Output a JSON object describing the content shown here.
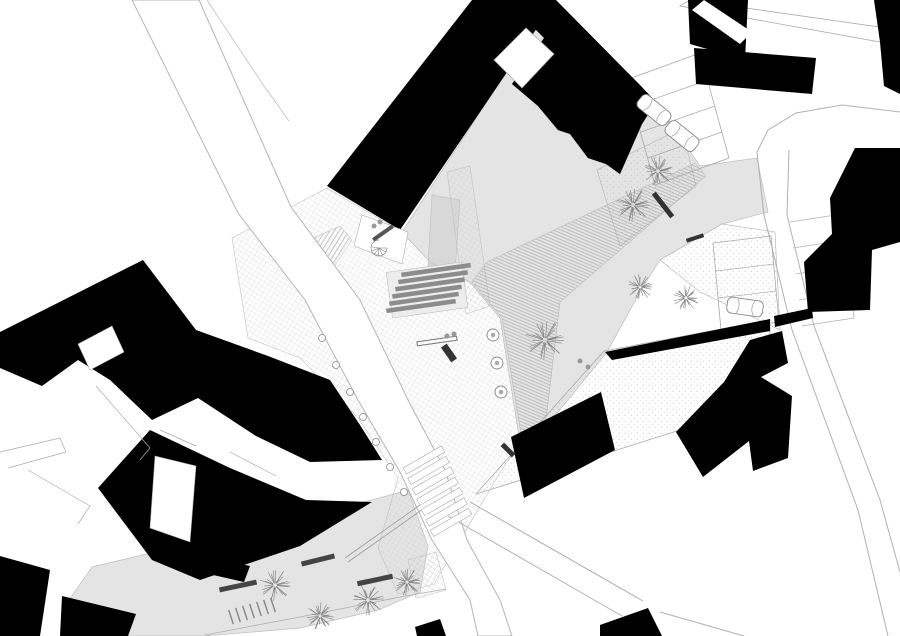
{
  "meta": {
    "type": "architectural-site-plan",
    "description": "black-and-white figure-ground site plan of a public plaza between buildings",
    "width": 900,
    "height": 636
  },
  "colors": {
    "building": "#000000",
    "plaza_gray": "#e4e4e4",
    "terrace_gray": "#d8d8d8",
    "road_line": "#b0b0b0",
    "outline": "#bdbdbd",
    "hatch_line": "#9c9c9c",
    "grid_line": "#c9c9c9",
    "stipple_dot": "#b8b8b8",
    "tree_line": "#808080",
    "bench_dark": "#333333",
    "background": "#ffffff"
  },
  "plan": {
    "layers": [
      {
        "name": "plaza-main-gray",
        "kind": "poly",
        "pts": "402,232 540,20 552,30 512,84 538,106 558,130 570,134 588,158 606,164 620,174 642,124 656,102 700,166 757,158 768,212 722,224 660,260 640,292 607,352 545,428 520,442 500,318 470,282 430,262",
        "fill": "#e4e4e4",
        "stroke": "#bdbdbd",
        "sw": 0.7
      },
      {
        "name": "courtyard-gray",
        "kind": "poly",
        "pts": "92,567 372,500 408,490 428,546 420,592 378,610 300,628 205,636 100,636 62,610",
        "fill": "#e4e4e4",
        "stroke": "#bdbdbd",
        "sw": 0.7
      },
      {
        "name": "terrace-strip-gray",
        "kind": "poly",
        "pts": "432,195 460,200 455,272 428,266",
        "fill": "#d8d8d8",
        "stroke": "#bdbdbd",
        "sw": 0.6
      },
      {
        "name": "planting-strip-upper",
        "kind": "poly",
        "pts": "597,170 682,128 696,186 620,246",
        "fill": "stip",
        "stroke": "#bbbbbb",
        "sw": 0.7
      },
      {
        "name": "planting-strip-lower",
        "kind": "poly",
        "pts": "722,224 775,232 780,330 700,292 660,260",
        "fill": "stip",
        "stroke": "#bbbbbb",
        "sw": 0.7
      },
      {
        "name": "stipple-wedge",
        "kind": "poly",
        "pts": "476,494 604,351 770,320 770,334 680,430 560,468",
        "fill": "stip",
        "stroke": "#aaaaaa",
        "sw": 0.8
      },
      {
        "name": "paving-grid-main",
        "kind": "poly",
        "pts": "232,238 327,188 402,232 430,262 470,282 500,318 520,442 498,476 434,584 398,594 378,548 398,478 358,418 300,358 248,338",
        "fill": "grid",
        "stroke": "#c2c2c2",
        "sw": 0.6
      },
      {
        "name": "paving-grid-walkway",
        "kind": "poly",
        "pts": "447,172 470,166 490,306 466,314",
        "fill": "grid",
        "stroke": "#c2c2c2",
        "sw": 0.6
      },
      {
        "name": "paving-grid-south",
        "kind": "poly",
        "pts": "408,560 436,552 446,590 416,598",
        "fill": "grid",
        "stroke": "#c2c2c2",
        "sw": 0.6
      },
      {
        "name": "stepped-ramp-hatch",
        "kind": "poly",
        "pts": "487,262 695,163 706,176 560,302 545,428 522,440 502,318 472,282",
        "fill": "diagA",
        "stroke": "#b0b0b0",
        "sw": 0.5
      },
      {
        "name": "ramp-hatch-west",
        "kind": "poly",
        "pts": "296,246 340,226 352,240 314,296 296,288",
        "fill": "diagB",
        "stroke": "#b0b0b0",
        "sw": 0.5
      },
      {
        "name": "street-west",
        "kind": "poly",
        "pts": "132,0 199,0 291,207 360,300 408,400 445,470 467,540 500,600 512,636 478,636 470,600 432,540 400,472 358,400 305,300 238,213",
        "fill": "#ffffff",
        "stroke": "#b5b5b5",
        "sw": 1
      },
      {
        "name": "street-west-inner-line",
        "kind": "pline",
        "pts": "207,0 262,83 289,121",
        "stroke": "#c0c0c0",
        "sw": 0.8
      },
      {
        "name": "street-east-edge-a",
        "kind": "pline",
        "pts": "757,152 764,215 792,330 858,510 888,636",
        "stroke": "#b0b0b0",
        "sw": 1
      },
      {
        "name": "street-east-edge-b",
        "kind": "pline",
        "pts": "789,150 787,215 814,326 880,500 900,572",
        "stroke": "#b0b0b0",
        "sw": 1
      },
      {
        "name": "street-corner-curve",
        "kind": "pline",
        "pts": "757,152 768,130 796,113 842,105 900,112",
        "stroke": "#b0b0b0",
        "sw": 1
      },
      {
        "name": "street-south-edge-a",
        "kind": "pline",
        "pts": "448,516 622,616",
        "stroke": "#b0b0b0",
        "sw": 1
      },
      {
        "name": "street-south-edge-b",
        "kind": "pline",
        "pts": "470,502 643,601",
        "stroke": "#b0b0b0",
        "sw": 1
      },
      {
        "name": "street-south-edge-c",
        "kind": "pline",
        "pts": "660,612 744,636",
        "stroke": "#b0b0b0",
        "sw": 1
      },
      {
        "name": "link-bridge-outline",
        "kind": "poly",
        "pts": "680,6 690,0 886,28 880,42",
        "fill": "#ffffff",
        "stroke": "#aaaaaa",
        "sw": 0.8
      },
      {
        "name": "parking-stalls-east",
        "kind": "seg",
        "segs": [
          [
            790,
            222,
            842,
            214
          ],
          [
            793,
            248,
            845,
            240
          ],
          [
            796,
            274,
            848,
            266
          ],
          [
            799,
            300,
            851,
            292
          ],
          [
            802,
            326,
            854,
            318
          ],
          [
            842,
            214,
            854,
            318
          ]
        ],
        "stroke": "#b0b0b0",
        "sw": 0.8
      },
      {
        "name": "parking-bay-mid",
        "kind": "poly",
        "pts": "713,243 771,236 779,322 721,330",
        "fill": "none",
        "stroke": "#a8a8a8",
        "sw": 0.8
      },
      {
        "name": "parking-bay-mid-dividers",
        "kind": "seg",
        "segs": [
          [
            716,
            271,
            774,
            264
          ],
          [
            718,
            298,
            776,
            291
          ]
        ],
        "stroke": "#a8a8a8",
        "sw": 0.7
      },
      {
        "name": "parking-bay-north",
        "kind": "poly",
        "pts": "626,80 700,53 729,158 655,185",
        "fill": "none",
        "stroke": "#a8a8a8",
        "sw": 0.8
      },
      {
        "name": "parking-bay-north-dividers",
        "kind": "seg",
        "segs": [
          [
            634,
            106,
            708,
            80
          ],
          [
            641,
            132,
            715,
            106
          ],
          [
            648,
            158,
            722,
            132
          ]
        ],
        "stroke": "#a8a8a8",
        "sw": 0.7
      },
      {
        "name": "building-band-nw",
        "kind": "poly",
        "pts": "327,186 472,0 556,0 400,230",
        "fill": "#000000"
      },
      {
        "name": "building-band-ne",
        "kind": "poly",
        "pts": "556,0 640,85 656,102 642,124 620,174 606,164 588,158 570,134 558,130 538,106 512,84 544,38 528,22 548,0",
        "fill": "#000000"
      },
      {
        "name": "building-courtyard-notch",
        "kind": "poly",
        "pts": "494,60 526,28 554,54 522,88",
        "fill": "#ffffff",
        "stroke": "#aaaaaa",
        "sw": 0.7
      },
      {
        "name": "building-tr-a",
        "kind": "poly",
        "pts": "688,0 748,0 745,60 690,44",
        "fill": "#000000"
      },
      {
        "name": "building-tr-a-slot",
        "kind": "poly",
        "pts": "692,10 704,0 752,32 740,44",
        "fill": "#ffffff"
      },
      {
        "name": "building-tr-b",
        "kind": "poly",
        "pts": "694,48 816,58 812,94 696,84",
        "fill": "#000000"
      },
      {
        "name": "building-edge-ne",
        "kind": "poly",
        "pts": "874,0 900,0 900,94 884,86 880,42",
        "fill": "#000000"
      },
      {
        "name": "building-east-stepped",
        "kind": "poly",
        "pts": "855,148 900,148 900,242 872,250 870,310 808,312 804,262 832,234 830,198",
        "fill": "#000000"
      },
      {
        "name": "building-wedge-sliver",
        "kind": "poly",
        "pts": "605,352 770,319 770,331 612,360",
        "fill": "#000000"
      },
      {
        "name": "building-wedge-sliver-b",
        "kind": "poly",
        "pts": "774,316 812,308 813,318 775,327",
        "fill": "#000000"
      },
      {
        "name": "building-z-block",
        "kind": "poly",
        "pts": "676,432 724,382 750,340 782,331 788,363 761,377 792,396 788,458 753,471 749,441 703,477",
        "fill": "#000000"
      },
      {
        "name": "building-parallelogram",
        "kind": "poly",
        "pts": "511,437 601,392 615,450 524,498",
        "fill": "#000000"
      },
      {
        "name": "building-corner-south",
        "kind": "poly",
        "pts": "600,625 648,608 662,636 600,636",
        "fill": "#000000"
      },
      {
        "name": "building-south-small",
        "kind": "poly",
        "pts": "415,627 440,619 446,636 417,636",
        "fill": "#000000"
      },
      {
        "name": "building-west-upper",
        "kind": "poly",
        "pts": "0,332 143,260 196,330 268,356 330,380 360,425 382,460 310,462 256,436 198,398 152,420 110,380 78,360 42,386 0,368",
        "fill": "#000000"
      },
      {
        "name": "building-west-upper-court",
        "kind": "poly",
        "pts": "78,344 112,326 124,352 90,370",
        "fill": "#ffffff",
        "stroke": "#aaaaaa",
        "sw": 0.6
      },
      {
        "name": "building-west-lower",
        "kind": "poly",
        "pts": "150,430 230,468 306,500 372,502 300,546 200,580 152,560 122,520 98,488",
        "fill": "#000000"
      },
      {
        "name": "building-west-lower-court",
        "kind": "poly",
        "pts": "155,456 196,466 190,542 150,528",
        "fill": "#ffffff",
        "stroke": "#aaaaaa",
        "sw": 0.6
      },
      {
        "name": "building-sw-corner-a",
        "kind": "poly",
        "pts": "0,556 50,570 40,636 0,636",
        "fill": "#000000"
      },
      {
        "name": "building-sw-corner-b",
        "kind": "poly",
        "pts": "62,596 136,614 128,636 60,636",
        "fill": "#000000"
      },
      {
        "name": "building-sw-small",
        "kind": "poly",
        "pts": "204,556 250,566 244,582 200,572",
        "fill": "#000000"
      },
      {
        "name": "terrace-pocket",
        "kind": "poly",
        "pts": "362,215 408,232 402,264 354,246",
        "fill": "#ffffff",
        "stroke": "#bbbbbb",
        "sw": 0.7
      },
      {
        "name": "structure-lines-west",
        "kind": "seg",
        "segs": [
          [
            0,
            452,
            60,
            438
          ],
          [
            60,
            438,
            66,
            452
          ],
          [
            66,
            452,
            8,
            468
          ],
          [
            28,
            470,
            90,
            506
          ],
          [
            90,
            506,
            78,
            524
          ],
          [
            96,
            386,
            150,
            448
          ],
          [
            150,
            448,
            140,
            460
          ],
          [
            160,
            430,
            196,
            446
          ],
          [
            230,
            452,
            276,
            476
          ]
        ],
        "stroke": "#aaaaaa",
        "sw": 0.7
      },
      {
        "name": "courtyard-ramp-wall",
        "kind": "seg",
        "segs": [
          [
            345,
            558,
            420,
            505
          ],
          [
            348,
            562,
            423,
            509
          ]
        ],
        "stroke": "#999999",
        "sw": 0.8
      },
      {
        "name": "courtyard-south-edge",
        "kind": "pline",
        "pts": "205,635 300,617 400,597 446,589",
        "stroke": "#b0b0b0",
        "sw": 0.8
      },
      {
        "name": "steps-base",
        "kind": "bar",
        "x": 427,
        "y": 290,
        "len": 76,
        "w": 46,
        "rot": -8,
        "fill": "#ededed",
        "stroke": "#bbbbbb",
        "sw": 0.6
      },
      {
        "name": "steps-treads",
        "kind": "bars",
        "len": 70,
        "w": 4.5,
        "rot": -8,
        "fill": "#8c8c8c",
        "items": [
          [
            436,
            270
          ],
          [
            433,
            277.2
          ],
          [
            430,
            284.4
          ],
          [
            427,
            291.6
          ],
          [
            424,
            298.8
          ],
          [
            421,
            306
          ]
        ]
      },
      {
        "name": "crosswalk-stripes",
        "kind": "bars",
        "len": 44,
        "w": 7,
        "rot": -30,
        "fill": "#ffffff",
        "stroke": "#aaaaaa",
        "sw": 0.6,
        "items": [
          [
            424,
            460
          ],
          [
            428.5,
            470.4
          ],
          [
            433,
            480.8
          ],
          [
            437.5,
            491.2
          ],
          [
            442,
            501.6
          ],
          [
            446.5,
            512
          ],
          [
            451,
            522.4
          ]
        ]
      },
      {
        "name": "bike-racks",
        "kind": "bars",
        "len": 15,
        "w": 1.4,
        "rot": 72,
        "fill": "#888888",
        "items": [
          [
            231,
            617
          ],
          [
            238,
            615
          ],
          [
            245,
            613
          ],
          [
            252,
            611
          ],
          [
            259,
            609
          ],
          [
            266,
            607
          ],
          [
            273,
            605
          ]
        ]
      },
      {
        "name": "bench-terrace",
        "kind": "bar",
        "x": 383,
        "y": 233,
        "len": 24,
        "w": 4,
        "rot": -35,
        "fill": "#555555"
      },
      {
        "name": "bench-plaza-long",
        "kind": "bar",
        "x": 437,
        "y": 341,
        "len": 40,
        "w": 4,
        "rot": -8,
        "fill": "none",
        "stroke": "#777777",
        "sw": 1
      },
      {
        "name": "bench-plaza-dark",
        "kind": "bar",
        "x": 449,
        "y": 353,
        "len": 18,
        "w": 7,
        "rot": 55,
        "fill": "#333333"
      },
      {
        "name": "bench-upper-east",
        "kind": "bar",
        "x": 663,
        "y": 205,
        "len": 30,
        "w": 5,
        "rot": 52,
        "fill": "#333333"
      },
      {
        "name": "bench-strip-east",
        "kind": "bar",
        "x": 695,
        "y": 238,
        "len": 18,
        "w": 4,
        "rot": -18,
        "fill": "#333333"
      },
      {
        "name": "bench-courtyard-a",
        "kind": "bar",
        "x": 238,
        "y": 586,
        "len": 38,
        "w": 5,
        "rot": -12,
        "fill": "#444444"
      },
      {
        "name": "bench-courtyard-b",
        "kind": "bar",
        "x": 375,
        "y": 580,
        "len": 36,
        "w": 5,
        "rot": -12,
        "fill": "#444444"
      },
      {
        "name": "bench-courtyard-c",
        "kind": "bar",
        "x": 318,
        "y": 560,
        "len": 34,
        "w": 5,
        "rot": -14,
        "fill": "#444444"
      },
      {
        "name": "bench-wedge",
        "kind": "bar",
        "x": 508,
        "y": 450,
        "len": 16,
        "w": 5,
        "rot": 45,
        "fill": "#333333"
      },
      {
        "name": "bollard-row",
        "kind": "dot",
        "r": 3.5,
        "fill": "#ffffff",
        "stroke": "#888888",
        "sw": 0.8,
        "items": [
          [
            322,
            338
          ],
          [
            336,
            365
          ],
          [
            350,
            392
          ],
          [
            363,
            417
          ],
          [
            376,
            442
          ],
          [
            390,
            467
          ],
          [
            404,
            492
          ]
        ]
      },
      {
        "name": "people-dots",
        "kind": "dot",
        "r": 2.5,
        "fill": "#999999",
        "stroke": "none",
        "sw": 0,
        "items": [
          [
            374,
            226
          ],
          [
            380,
            222
          ],
          [
            447,
            336
          ],
          [
            454,
            334
          ],
          [
            580,
            361
          ],
          [
            588,
            367
          ]
        ]
      },
      {
        "name": "tree-pits",
        "kind": "pit",
        "r": 6,
        "items": [
          [
            493,
            335
          ],
          [
            497,
            363
          ],
          [
            501,
            392
          ]
        ]
      },
      {
        "name": "spiral-stair",
        "kind": "spiral",
        "x": 379,
        "y": 248,
        "r": 8
      },
      {
        "name": "tree",
        "kind": "tree",
        "x": 633,
        "y": 205,
        "r": 17
      },
      {
        "name": "tree",
        "kind": "tree",
        "x": 658,
        "y": 171,
        "r": 15
      },
      {
        "name": "tree",
        "kind": "tree",
        "x": 640,
        "y": 287,
        "r": 13
      },
      {
        "name": "tree",
        "kind": "tree",
        "x": 686,
        "y": 298,
        "r": 13
      },
      {
        "name": "tree",
        "kind": "tree",
        "x": 545,
        "y": 340,
        "r": 20
      },
      {
        "name": "tree",
        "kind": "tree",
        "x": 275,
        "y": 585,
        "r": 16
      },
      {
        "name": "tree",
        "kind": "tree",
        "x": 320,
        "y": 616,
        "r": 14
      },
      {
        "name": "tree",
        "kind": "tree",
        "x": 368,
        "y": 600,
        "r": 16
      },
      {
        "name": "tree",
        "kind": "tree",
        "x": 407,
        "y": 582,
        "r": 14
      },
      {
        "name": "car",
        "kind": "car",
        "x": 654,
        "y": 110,
        "rot": 39
      },
      {
        "name": "car",
        "kind": "car",
        "x": 682,
        "y": 136,
        "rot": 39
      },
      {
        "name": "car",
        "kind": "car",
        "x": 745,
        "y": 307,
        "rot": 8
      }
    ]
  }
}
